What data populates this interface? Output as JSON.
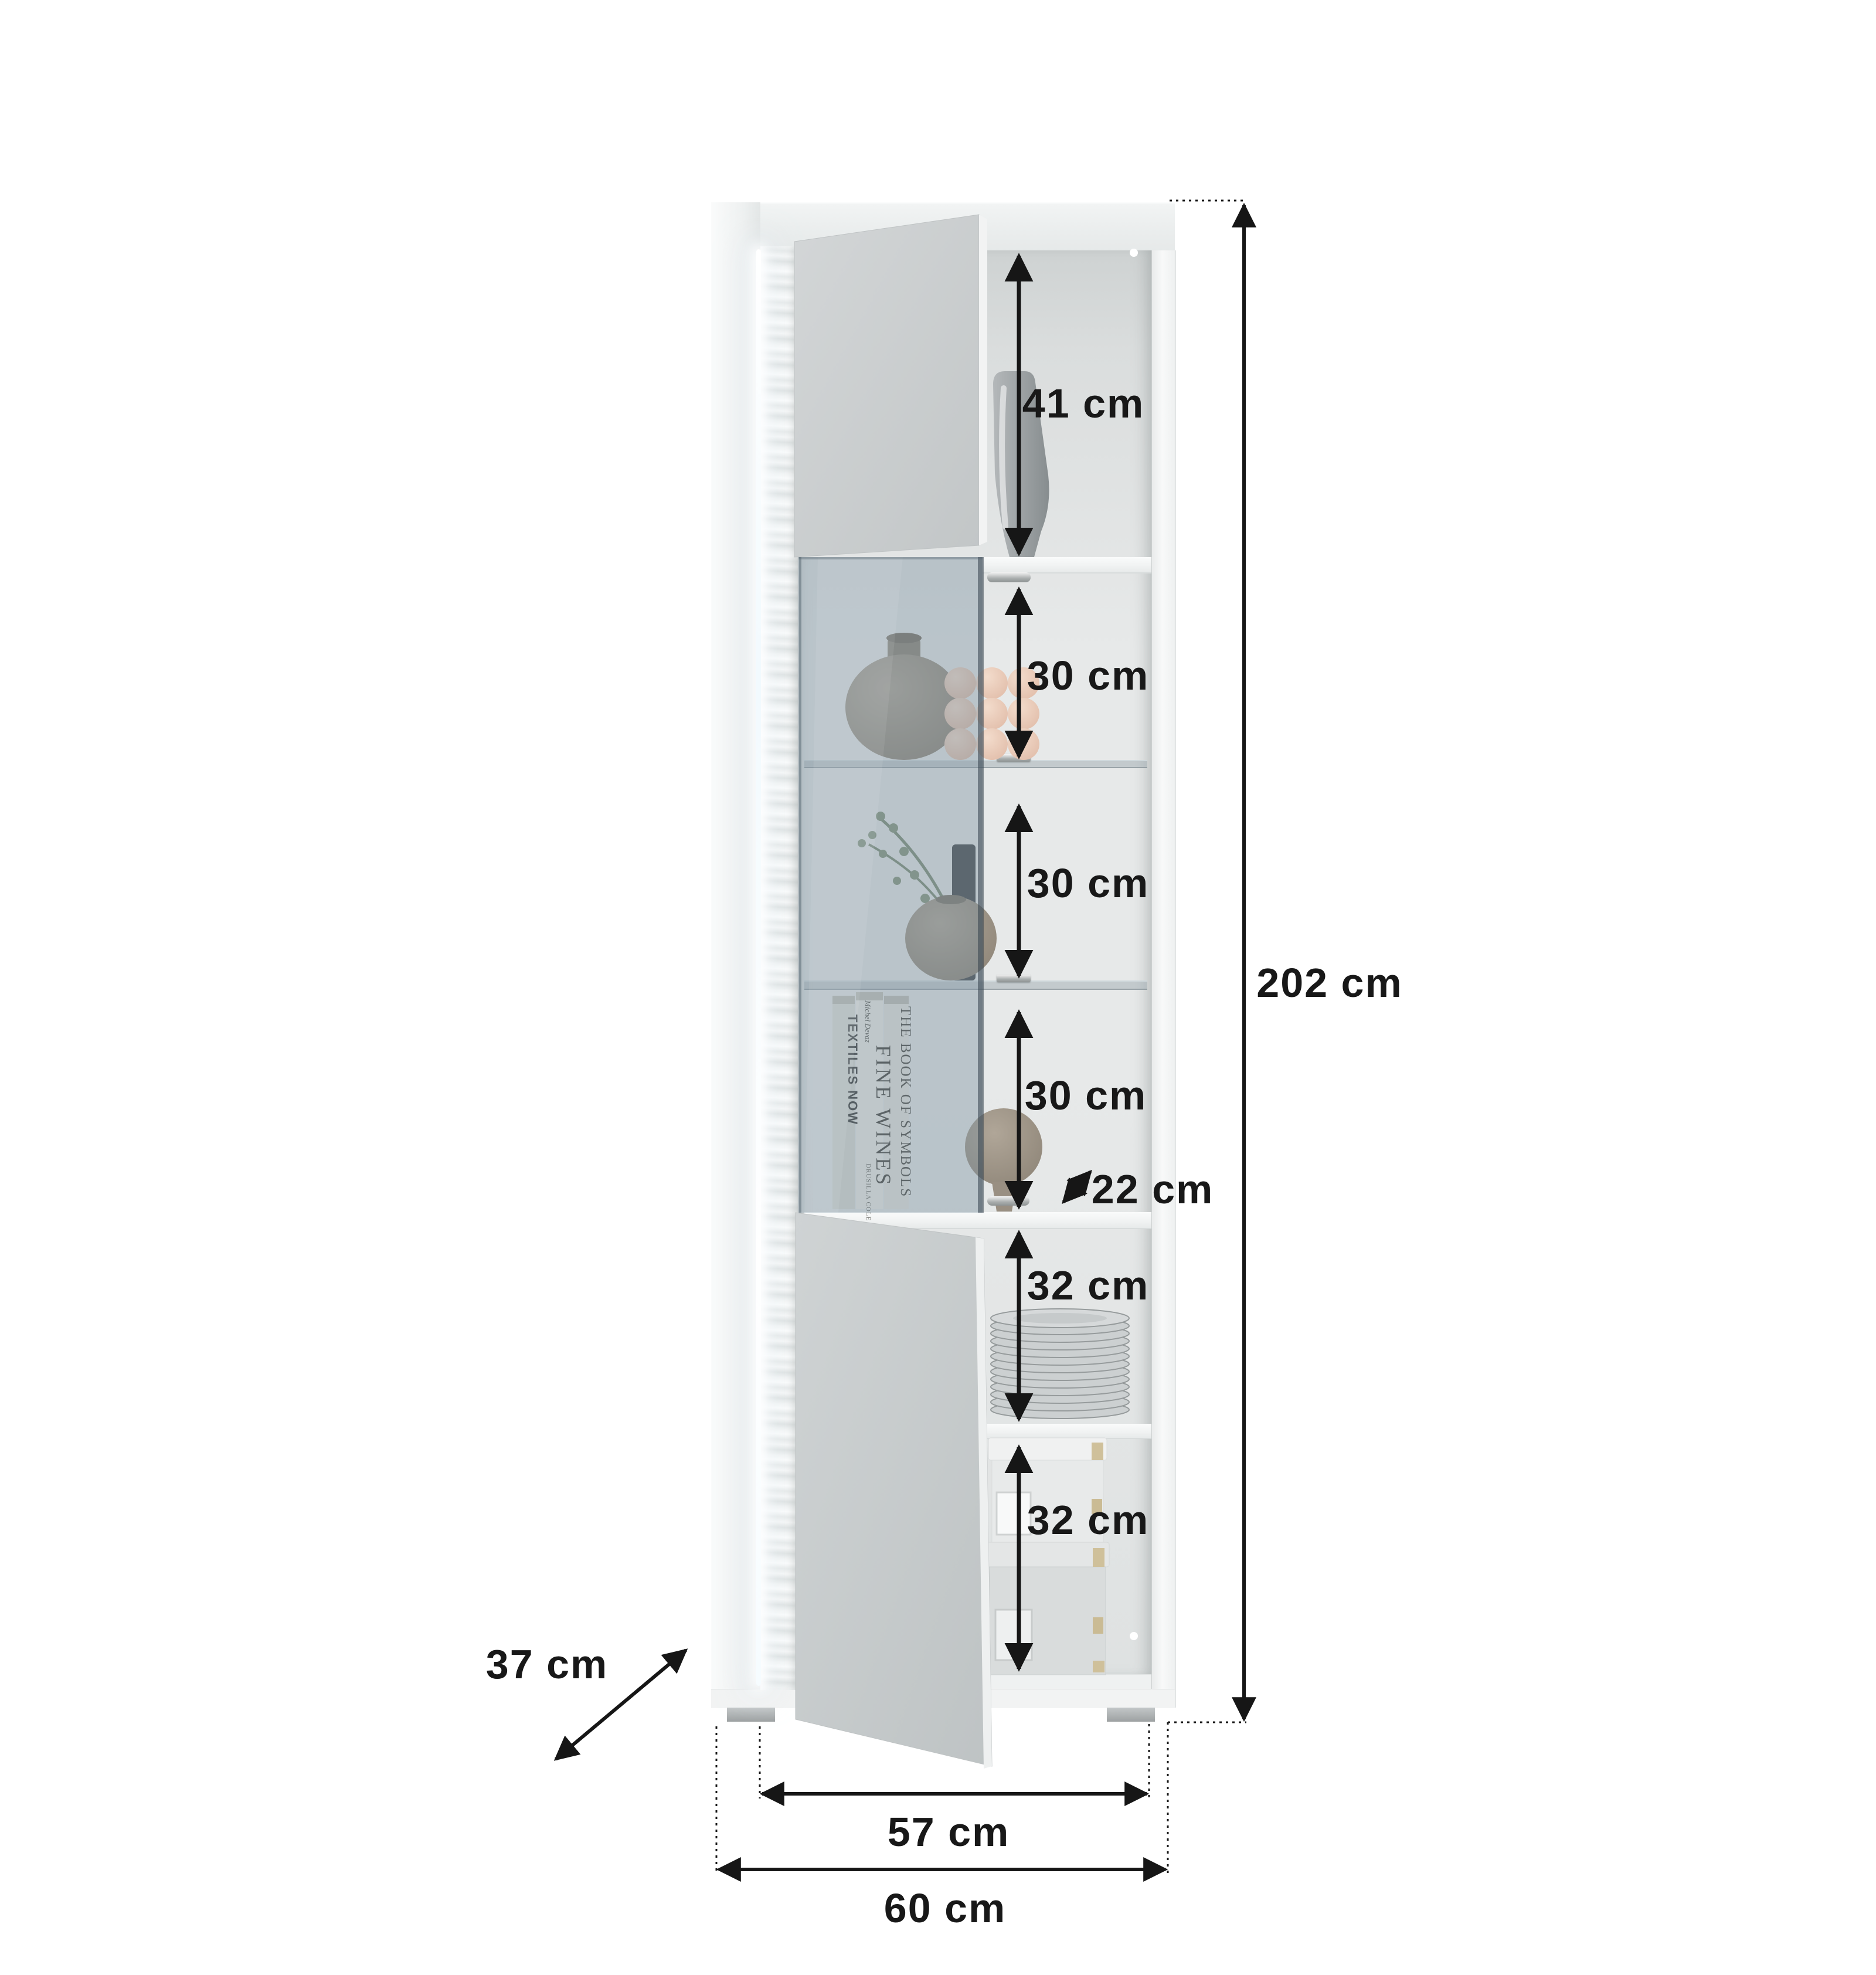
{
  "diagram": {
    "type": "furniture-dimension-diagram",
    "subject": "tall display cabinet with open doors, glass vitrine section and LED-lit fluted front edge",
    "units": "cm"
  },
  "labels": {
    "s41": "41 cm",
    "s30a": "30 cm",
    "s30b": "30 cm",
    "s30c": "30 cm",
    "s22": "22 cm",
    "s32a": "32 cm",
    "s32b": "32 cm",
    "height": "202 cm",
    "depth": "37 cm",
    "inner_width": "57 cm",
    "outer_width": "60 cm"
  },
  "dimensions_cm": {
    "total_height": 202,
    "total_width": 60,
    "inner_width": 57,
    "depth": 37,
    "sections_top_to_bottom": [
      41,
      30,
      30,
      30,
      32,
      32
    ],
    "shelf_clear_depth": 22
  },
  "books": {
    "textiles": "TEXTILES NOW",
    "fine_wines_author": "Michel Devaz",
    "fine_wines": "FINE WINES",
    "fine_wines_footer": "DRUSILLA COLE",
    "symbols": "THE BOOK OF SYMBOLS"
  },
  "colors": {
    "line": "#161616",
    "door_gray": "#c9cdce",
    "glass_tint": "rgba(125,146,160,0.42)",
    "carcass_white": "#f5f6f6",
    "accent_gold": "#cfc09a"
  }
}
